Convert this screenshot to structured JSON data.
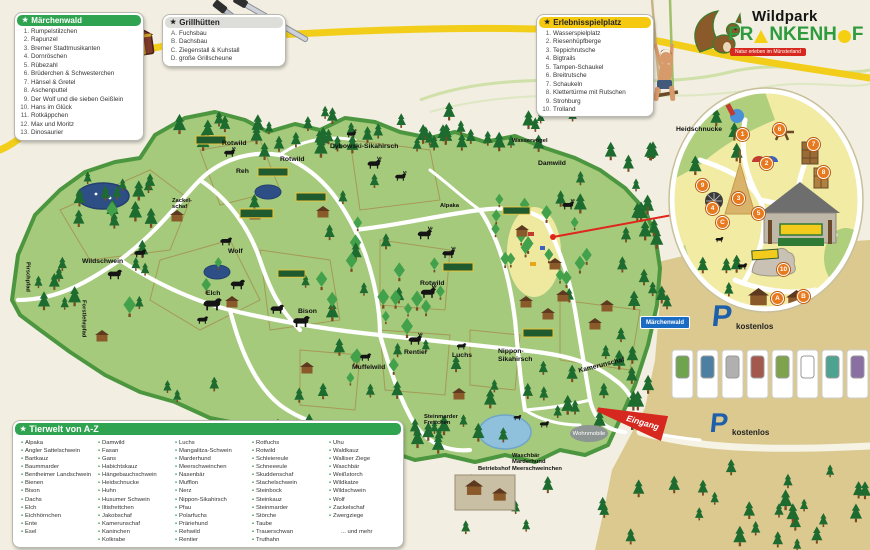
{
  "icons": {
    "legend_star": "★"
  },
  "legend_maerchenwald": {
    "title": "Märchenwald",
    "items": [
      "Rumpelstilzchen",
      "Rapunzel",
      "Bremer Stadtmusikanten",
      "Dornröschen",
      "Rübezahl",
      "Brüderchen & Schwesterchen",
      "Hänsel & Gretel",
      "Aschenputtel",
      "Der Wolf und die sieben Geißlein",
      "Hans im Glück",
      "Rotkäppchen",
      "Max und Moritz",
      "Dinosaurier"
    ]
  },
  "legend_grillhuetten": {
    "title": "Grillhütten",
    "items": [
      "Fuchsbau",
      "Dachsbau",
      "Ziegenstall & Kuhstall",
      "große Grillscheune"
    ]
  },
  "legend_spielplatz": {
    "title": "Erlebnisspielplatz",
    "items": [
      "Wasserspielplatz",
      "Riesenhüpfberge",
      "Teppichrutsche",
      "Bigtrails",
      "Tampen-Schaukel",
      "Breitrutsche",
      "Schaukeln",
      "Klettertürme mit Rutschen",
      "Strohburg",
      "Trolland"
    ]
  },
  "legend_tierwelt": {
    "title": "Tierwelt von A-Z",
    "columns": [
      [
        "Alpaka",
        "Angler Sattelschwein",
        "Bartkauz",
        "Baummarder",
        "Bentheimer Landschwein",
        "Bienen",
        "Bison",
        "Dachs",
        "Elch",
        "Eichhörnchen",
        "Ente",
        "Esel"
      ],
      [
        "Damwild",
        "Fasan",
        "Gans",
        "Habichtskauz",
        "Hängebauchschwein",
        "Heidschnucke",
        "Huhn",
        "Husumer Schwein",
        "Iltisfrettchen",
        "Jakobschaf",
        "Kamerunschaf",
        "Kaninchen",
        "Kolkrabe"
      ],
      [
        "Luchs",
        "Mangalitza-Schwein",
        "Marderhund",
        "Meerschweinchen",
        "Nasenbär",
        "Mufflon",
        "Nerz",
        "Nippon-Sikahirsch",
        "Pfau",
        "Polarfuchs",
        "Präriehund",
        "Rehwild",
        "Rentier"
      ],
      [
        "Rotfuchs",
        "Rotwild",
        "Schleiereule",
        "Schneeeule",
        "Skuddenschaf",
        "Stachelschwein",
        "Steinbock",
        "Steinkauz",
        "Steinmarder",
        "Störche",
        "Taube",
        "Trauerschwan",
        "Truthahn"
      ],
      [
        "Uhu",
        "Waldkauz",
        "Walliser Ziege",
        "Waschbär",
        "Weißstorch",
        "Wildkatze",
        "Wildschwein",
        "Wolf",
        "Zackelschaf",
        "Zwergziege"
      ]
    ],
    "more": "... und mehr"
  },
  "logo": {
    "wildpark": "Wildpark",
    "f_p1": "FR",
    "f_p2": "NKENH",
    "f_p3": "F",
    "tagline": "Natur erleben im Münsterland"
  },
  "map": {
    "labels": {
      "wildschwein": "Wildschwein",
      "elch": "Elch",
      "bison": "Bison",
      "wolf": "Wolf",
      "rotwild": "Rotwild",
      "reh": "Reh",
      "dybowski": "Dybowski-Sikahirsch",
      "damwild": "Damwild",
      "wasservoegel": "Wasservögel",
      "alpaka": "Alpaka",
      "zackel1": "Zackel-",
      "zackel2": "schaf",
      "muffelwild": "Muffelwild",
      "rentier": "Rentier",
      "luchs": "Luchs",
      "nippon1": "Nippon-",
      "nippon2": "Sikahirsch",
      "kamerunschaf": "Kamerunschaf",
      "steinmarder1": "Steinmarder",
      "steinmarder2": "Frettchen",
      "waschbaer1": "Waschbär",
      "waschbaer2": "Marderhund",
      "waschbaer3": "Meerschweinchen",
      "betriebshof": "Betriebshof",
      "heidschnucke": "Heidschnucke",
      "pirschpfad": "Pirschpfad",
      "forstlehrpfad": "Forstlehrpfad"
    },
    "badges": [
      "1",
      "2",
      "3",
      "4",
      "5",
      "6",
      "7",
      "8",
      "9",
      "10",
      "A",
      "B",
      "C"
    ],
    "signs": {
      "maerchenwald": "Märchenwald",
      "eingang": "Eingang",
      "wohnmobile": "Wohnmobile",
      "parking_p": "P",
      "parking_kostenlos": "kostenlos"
    },
    "colors": {
      "park_green": "#A5CA7C",
      "park_border": "#4C9640",
      "trail": "#FFFFFF",
      "parking_tan": "#DBC98F",
      "road_yellow": "#F2CE1B",
      "accent_red": "#D6281E",
      "badge_orange": "#E8791D",
      "parking_blue": "#1D5FAB",
      "header_green": "#2FA350"
    }
  }
}
